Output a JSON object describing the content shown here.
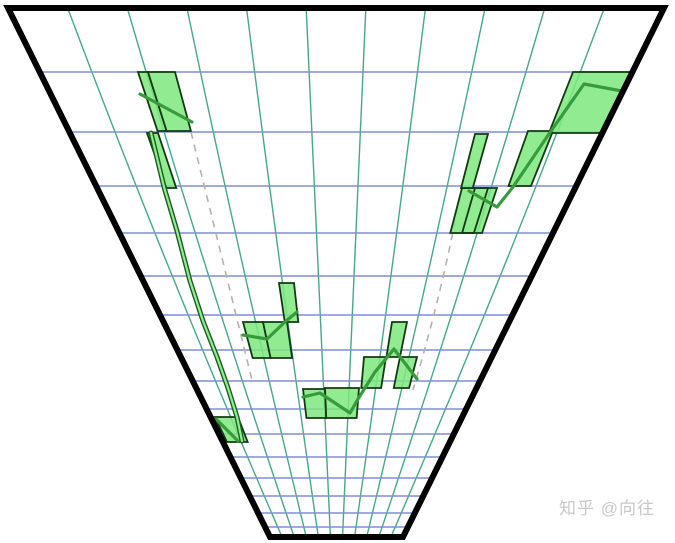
{
  "watermark": {
    "text": "知乎 @向往"
  },
  "chart_data": {
    "type": "area",
    "title": "",
    "description": "Perspective funnel grid with green candle-like boxes and trend polylines forming a V (valley) shape; dashed gray V trendlines",
    "colors": {
      "background": "#ffffff",
      "funnel_border": "#000000",
      "vertical_grid": "#44a88c",
      "horizontal_grid": "#7e8fd6",
      "box_fill": "#7ee87e",
      "box_stroke": "#123a12",
      "trend_line": "#379b3c",
      "band_dark": "#1c5c20",
      "band_light": "#90ee90",
      "dashed_line": "#b8b0b0"
    },
    "funnel": {
      "corners": [
        [
          8,
          8
        ],
        [
          664,
          8
        ],
        [
          403,
          537
        ],
        [
          270,
          537
        ]
      ],
      "border_width": 6
    },
    "perspective": {
      "vanishing_point": [
        336.6,
        671.5
      ],
      "vertical_line_count": 10,
      "vertical_bow_factor": 0.03
    },
    "grid": {
      "horizontal_y": [
        72,
        132,
        186,
        233,
        276,
        315,
        350,
        381,
        409,
        434,
        457,
        478,
        496,
        513,
        527
      ]
    },
    "boxes": [
      {
        "x": [
          138,
          148
        ],
        "y": [
          72,
          131
        ]
      },
      {
        "x": [
          148,
          175
        ],
        "y": [
          72,
          131
        ]
      },
      {
        "x": [
          147,
          158
        ],
        "y": [
          133,
          188
        ]
      },
      {
        "x": [
          215,
          238
        ],
        "y": [
          417,
          442
        ]
      },
      {
        "x": [
          243,
          263
        ],
        "y": [
          322,
          358
        ]
      },
      {
        "x": [
          263,
          287
        ],
        "y": [
          322,
          358
        ]
      },
      {
        "x": [
          279,
          294
        ],
        "y": [
          283,
          322
        ]
      },
      {
        "x": [
          303,
          325
        ],
        "y": [
          389,
          418
        ]
      },
      {
        "x": [
          325,
          359
        ],
        "y": [
          388,
          418
        ]
      },
      {
        "x": [
          364,
          386
        ],
        "y": [
          357,
          388
        ]
      },
      {
        "x": [
          400,
          417
        ],
        "y": [
          357,
          388
        ]
      },
      {
        "x": [
          392,
          407
        ],
        "y": [
          322,
          357
        ]
      },
      {
        "x": [
          462,
          497
        ],
        "y": [
          188,
          233
        ]
      },
      {
        "x": [
          475,
          488
        ],
        "y": [
          134,
          188
        ]
      },
      {
        "x": [
          528,
          553
        ],
        "y": [
          131,
          186
        ]
      },
      {
        "x": [
          573,
          662
        ],
        "y": [
          72,
          133
        ]
      },
      {
        "x": [
          475,
          488
        ],
        "y": [
          188,
          233
        ],
        "hollow": true
      }
    ],
    "chains": [
      {
        "points": [
          [
            140,
            94
          ],
          [
            192,
            122
          ]
        ]
      },
      {
        "points": [
          [
            216,
            419
          ],
          [
            238,
            441
          ]
        ]
      },
      {
        "points": [
          [
            243,
            335
          ],
          [
            267,
            339
          ],
          [
            286,
            321
          ],
          [
            297,
            312
          ]
        ]
      },
      {
        "points": [
          [
            303,
            397
          ],
          [
            320,
            393
          ],
          [
            350,
            413
          ],
          [
            358,
            399
          ],
          [
            375,
            372
          ],
          [
            394,
            349
          ],
          [
            417,
            379
          ]
        ]
      },
      {
        "points": [
          [
            469,
            191
          ],
          [
            497,
            207
          ],
          [
            513,
            187
          ],
          [
            551,
            131
          ],
          [
            584,
            84
          ],
          [
            622,
            91
          ],
          [
            634,
            95
          ]
        ]
      }
    ],
    "band": {
      "points": [
        [
          151,
          133
        ],
        [
          164,
          187
        ],
        [
          177,
          231
        ],
        [
          190,
          281
        ],
        [
          203,
          321
        ],
        [
          217,
          357
        ],
        [
          228,
          388
        ],
        [
          237,
          417
        ],
        [
          242,
          441
        ]
      ]
    },
    "dashed": [
      {
        "path": [
          [
            191,
            132
          ],
          [
            222,
            258
          ],
          [
            252,
            380
          ]
        ]
      },
      {
        "path": [
          [
            460,
            195
          ],
          [
            440,
            290
          ],
          [
            413,
            390
          ]
        ]
      }
    ]
  }
}
